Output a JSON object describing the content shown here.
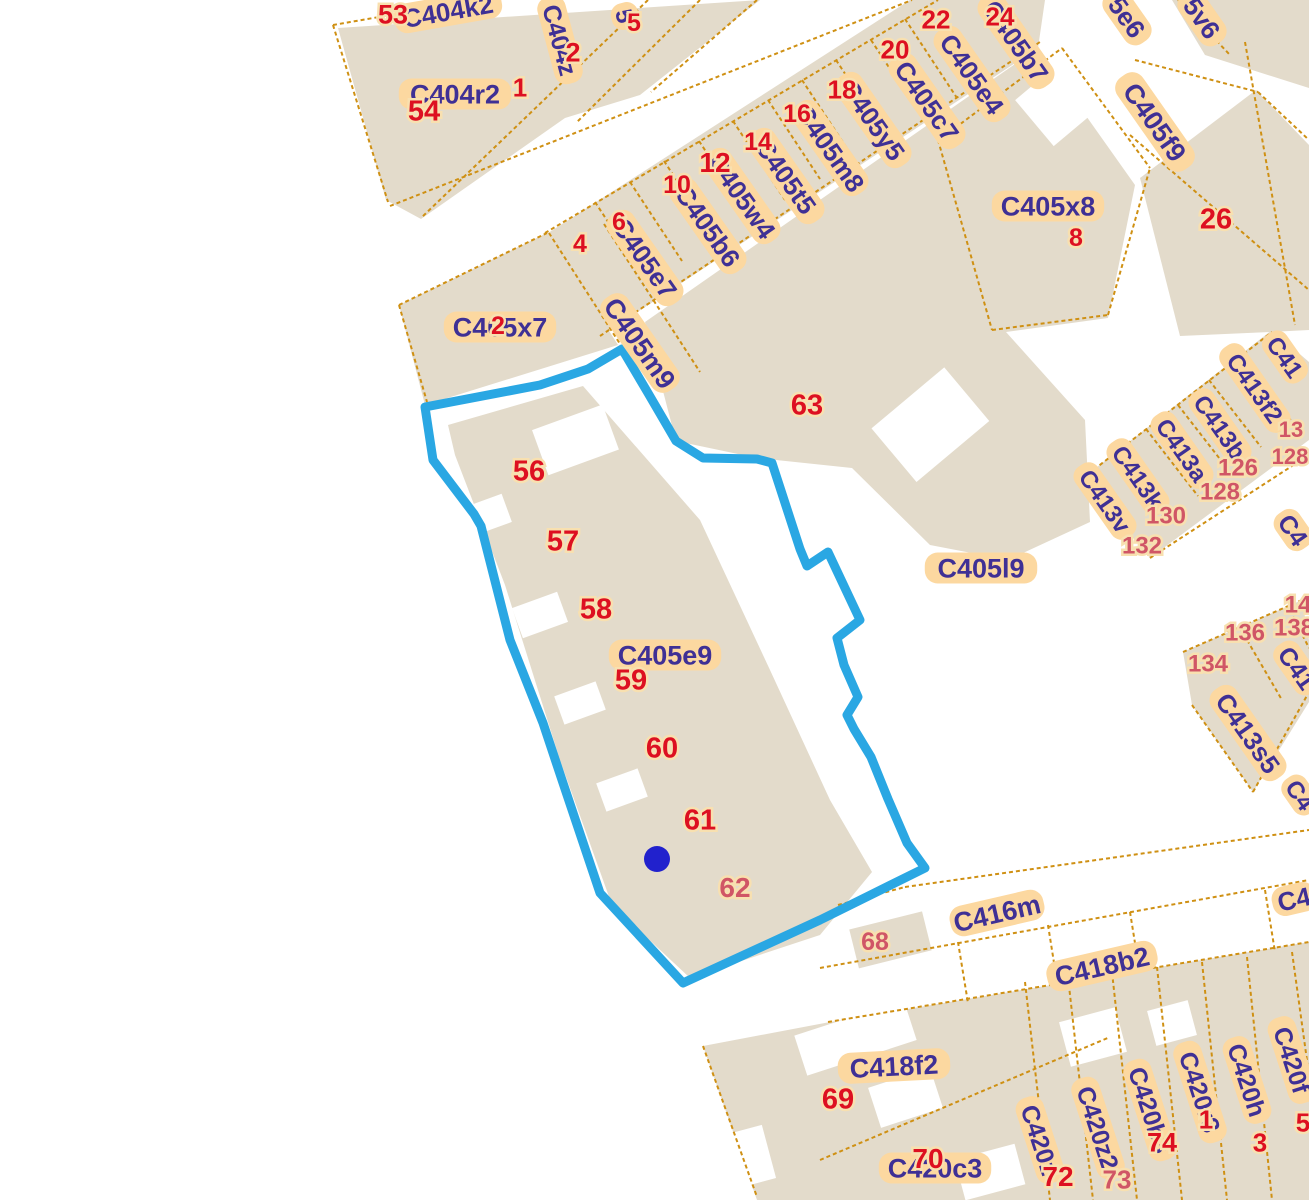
{
  "map": {
    "background_color": "#ffffff",
    "parcel_fill_color": "#e3dbcb",
    "boundary_color": "#cf9013",
    "label_bg_color": "#fcd8a0",
    "label_text_color": "#3f3095",
    "number_color": "#dd1021",
    "number_light_color": "#d05666",
    "highlight": {
      "color": "#2aa7e3",
      "stroke_width": 9,
      "polygon_points": "425,407 540,385 588,369 622,349 648,393 676,441 703,458 757,459 772,463 800,549 807,566 828,552 860,620 837,638 844,665 858,697 847,715 854,729 871,757 888,799 907,843 925,868 820,920 683,983 600,893 563,783 543,723 510,640 481,526 474,514 433,460",
      "marker_x": 657,
      "marker_y": 859,
      "marker_r": 13,
      "marker_color": "#2121cd"
    },
    "parcel_labels": [
      {
        "t": "C404k2",
        "x": 448,
        "y": 11,
        "r": -10,
        "fs": 26
      },
      {
        "t": "C404r2",
        "x": 455,
        "y": 94,
        "r": 0,
        "fs": 27
      },
      {
        "t": "C404z",
        "x": 560,
        "y": 40,
        "r": 75,
        "fs": 25
      },
      {
        "t": "5",
        "x": 625,
        "y": 16,
        "r": 75,
        "fs": 24
      },
      {
        "t": "C405e7",
        "x": 645,
        "y": 258,
        "r": 55,
        "fs": 26
      },
      {
        "t": "C405b6",
        "x": 708,
        "y": 226,
        "r": 55,
        "fs": 26
      },
      {
        "t": "C405w4",
        "x": 742,
        "y": 196,
        "r": 55,
        "fs": 26
      },
      {
        "t": "C405t5",
        "x": 786,
        "y": 176,
        "r": 55,
        "fs": 26
      },
      {
        "t": "C405m8",
        "x": 830,
        "y": 148,
        "r": 55,
        "fs": 26
      },
      {
        "t": "C405y5",
        "x": 873,
        "y": 120,
        "r": 55,
        "fs": 26
      },
      {
        "t": "C405c7",
        "x": 927,
        "y": 101,
        "r": 55,
        "fs": 26
      },
      {
        "t": "C405e4",
        "x": 972,
        "y": 74,
        "r": 55,
        "fs": 26
      },
      {
        "t": "C405b7",
        "x": 1016,
        "y": 41,
        "r": 55,
        "fs": 26
      },
      {
        "t": "5e6",
        "x": 1127,
        "y": 17,
        "r": 55,
        "fs": 26
      },
      {
        "t": "5v6",
        "x": 1202,
        "y": 18,
        "r": 55,
        "fs": 26
      },
      {
        "t": "C405f9",
        "x": 1155,
        "y": 122,
        "r": 55,
        "fs": 27
      },
      {
        "t": "C405x8",
        "x": 1048,
        "y": 206,
        "r": 0,
        "fs": 27
      },
      {
        "t": "C405x7",
        "x": 500,
        "y": 327,
        "r": 0,
        "fs": 27
      },
      {
        "t": "C405m9",
        "x": 640,
        "y": 343,
        "r": 55,
        "fs": 27
      },
      {
        "t": "C405e9",
        "x": 665,
        "y": 655,
        "r": 0,
        "fs": 27
      },
      {
        "t": "C405l9",
        "x": 981,
        "y": 568,
        "r": 0,
        "fs": 27
      },
      {
        "t": "C413v",
        "x": 1105,
        "y": 501,
        "r": 55,
        "fs": 24
      },
      {
        "t": "C413k",
        "x": 1138,
        "y": 477,
        "r": 55,
        "fs": 24
      },
      {
        "t": "C413a",
        "x": 1182,
        "y": 450,
        "r": 55,
        "fs": 24
      },
      {
        "t": "C413b",
        "x": 1220,
        "y": 427,
        "r": 55,
        "fs": 24
      },
      {
        "t": "C413f2",
        "x": 1255,
        "y": 388,
        "r": 55,
        "fs": 24
      },
      {
        "t": "C41",
        "x": 1285,
        "y": 357,
        "r": 55,
        "fs": 24
      },
      {
        "t": "C4",
        "x": 1293,
        "y": 530,
        "r": 55,
        "fs": 25
      },
      {
        "t": "C41",
        "x": 1297,
        "y": 668,
        "r": 55,
        "fs": 25
      },
      {
        "t": "C413s5",
        "x": 1248,
        "y": 733,
        "r": 55,
        "fs": 26
      },
      {
        "t": "C4",
        "x": 1300,
        "y": 795,
        "r": 55,
        "fs": 24
      },
      {
        "t": "C416m",
        "x": 997,
        "y": 913,
        "r": -13,
        "fs": 27
      },
      {
        "t": "C4",
        "x": 1294,
        "y": 899,
        "r": -13,
        "fs": 26
      },
      {
        "t": "C418b2",
        "x": 1102,
        "y": 966,
        "r": -13,
        "fs": 27
      },
      {
        "t": "C418f2",
        "x": 894,
        "y": 1066,
        "r": -3,
        "fs": 27
      },
      {
        "t": "C420c3",
        "x": 935,
        "y": 1168,
        "r": 0,
        "fs": 27
      },
      {
        "t": "C420z",
        "x": 1040,
        "y": 1140,
        "r": 72,
        "fs": 25
      },
      {
        "t": "C420z2",
        "x": 1098,
        "y": 1128,
        "r": 72,
        "fs": 25
      },
      {
        "t": "C420b3",
        "x": 1150,
        "y": 1110,
        "r": 72,
        "fs": 25
      },
      {
        "t": "C420r3",
        "x": 1200,
        "y": 1092,
        "r": 72,
        "fs": 25
      },
      {
        "t": "C420h",
        "x": 1247,
        "y": 1080,
        "r": 72,
        "fs": 25
      },
      {
        "t": "C420f",
        "x": 1292,
        "y": 1060,
        "r": 72,
        "fs": 25
      }
    ],
    "numbers": [
      {
        "t": "53",
        "x": 393,
        "y": 14,
        "fs": 27
      },
      {
        "t": "54",
        "x": 424,
        "y": 110,
        "fs": 29
      },
      {
        "t": "1",
        "x": 520,
        "y": 87,
        "fs": 26
      },
      {
        "t": "2",
        "x": 573,
        "y": 52,
        "fs": 27
      },
      {
        "t": "5",
        "x": 634,
        "y": 22,
        "fs": 25
      },
      {
        "t": "4",
        "x": 580,
        "y": 243,
        "fs": 25
      },
      {
        "t": "6",
        "x": 619,
        "y": 221,
        "fs": 25
      },
      {
        "t": "10",
        "x": 677,
        "y": 184,
        "fs": 25
      },
      {
        "t": "12",
        "x": 715,
        "y": 162,
        "fs": 28
      },
      {
        "t": "14",
        "x": 758,
        "y": 141,
        "fs": 25
      },
      {
        "t": "16",
        "x": 797,
        "y": 113,
        "fs": 25
      },
      {
        "t": "18",
        "x": 842,
        "y": 89,
        "fs": 26
      },
      {
        "t": "20",
        "x": 895,
        "y": 49,
        "fs": 26
      },
      {
        "t": "22",
        "x": 936,
        "y": 19,
        "fs": 26
      },
      {
        "t": "24",
        "x": 1000,
        "y": 16,
        "fs": 26
      },
      {
        "t": "8",
        "x": 1076,
        "y": 237,
        "fs": 25
      },
      {
        "t": "26",
        "x": 1216,
        "y": 218,
        "fs": 29
      },
      {
        "t": "2",
        "x": 498,
        "y": 325,
        "fs": 25
      },
      {
        "t": "63",
        "x": 807,
        "y": 404,
        "fs": 29
      },
      {
        "t": "56",
        "x": 529,
        "y": 470,
        "fs": 29
      },
      {
        "t": "57",
        "x": 563,
        "y": 540,
        "fs": 29
      },
      {
        "t": "58",
        "x": 596,
        "y": 608,
        "fs": 29
      },
      {
        "t": "59",
        "x": 631,
        "y": 679,
        "fs": 29
      },
      {
        "t": "60",
        "x": 662,
        "y": 747,
        "fs": 29
      },
      {
        "t": "61",
        "x": 700,
        "y": 819,
        "fs": 29
      },
      {
        "t": "62",
        "x": 735,
        "y": 887,
        "fs": 28,
        "light": true
      },
      {
        "t": "68",
        "x": 875,
        "y": 941,
        "fs": 25,
        "light": true
      },
      {
        "t": "126",
        "x": 1238,
        "y": 467,
        "fs": 24,
        "light": true
      },
      {
        "t": "128",
        "x": 1220,
        "y": 491,
        "fs": 24,
        "light": true
      },
      {
        "t": "130",
        "x": 1166,
        "y": 515,
        "fs": 24,
        "light": true
      },
      {
        "t": "132",
        "x": 1142,
        "y": 545,
        "fs": 24,
        "light": true
      },
      {
        "t": "13",
        "x": 1291,
        "y": 429,
        "fs": 22,
        "light": true
      },
      {
        "t": "128",
        "x": 1290,
        "y": 456,
        "fs": 22,
        "light": true
      },
      {
        "t": "134",
        "x": 1208,
        "y": 663,
        "fs": 24,
        "light": true
      },
      {
        "t": "136",
        "x": 1245,
        "y": 632,
        "fs": 24,
        "light": true
      },
      {
        "t": "138",
        "x": 1294,
        "y": 627,
        "fs": 24,
        "light": true
      },
      {
        "t": "14",
        "x": 1298,
        "y": 604,
        "fs": 24,
        "light": true
      },
      {
        "t": "69",
        "x": 838,
        "y": 1098,
        "fs": 29
      },
      {
        "t": "70",
        "x": 928,
        "y": 1158,
        "fs": 28
      },
      {
        "t": "72",
        "x": 1058,
        "y": 1176,
        "fs": 28
      },
      {
        "t": "73",
        "x": 1117,
        "y": 1179,
        "fs": 26,
        "light": true
      },
      {
        "t": "74",
        "x": 1162,
        "y": 1142,
        "fs": 27
      },
      {
        "t": "1",
        "x": 1206,
        "y": 1119,
        "fs": 26
      },
      {
        "t": "3",
        "x": 1260,
        "y": 1142,
        "fs": 26
      },
      {
        "t": "5",
        "x": 1303,
        "y": 1122,
        "fs": 26
      }
    ]
  }
}
